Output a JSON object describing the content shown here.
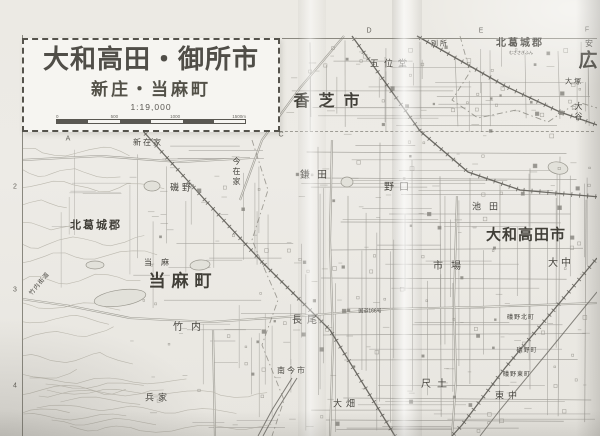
{
  "map": {
    "title_box": {
      "title": "大和高田・御所市",
      "subtitle": "新庄・当麻町",
      "scale": "1:19,000",
      "scale_bar_labels": [
        "0",
        "500",
        "1000",
        "1500m"
      ]
    },
    "colors": {
      "paper": "#edebe5",
      "street_line": "#a3a19b",
      "rail_line": "#5f5d57",
      "label_text": "#46443e",
      "title_text": "#504e48"
    },
    "grid_letters": [
      {
        "t": "A",
        "x": 68,
        "y": 139
      },
      {
        "t": "C",
        "x": 281,
        "y": 135
      },
      {
        "t": "D",
        "x": 369,
        "y": 31
      },
      {
        "t": "E",
        "x": 481,
        "y": 31
      },
      {
        "t": "F",
        "x": 587,
        "y": 30
      }
    ],
    "grid_numbers": [
      {
        "t": "2",
        "x": 15,
        "y": 187
      },
      {
        "t": "3",
        "x": 15,
        "y": 290
      },
      {
        "t": "4",
        "x": 15,
        "y": 386
      }
    ],
    "labels": [
      {
        "text": "香芝市",
        "x": 331,
        "y": 102,
        "size": 16,
        "ls": 9,
        "bold": true
      },
      {
        "text": "北葛城郡",
        "x": 520,
        "y": 44,
        "size": 10,
        "ls": 2,
        "bold": true
      },
      {
        "text": "むささぎふん",
        "x": 521,
        "y": 53,
        "size": 4,
        "ls": 0
      },
      {
        "text": "広",
        "x": 588,
        "y": 61,
        "size": 19,
        "ls": 0,
        "bold": true
      },
      {
        "text": "安",
        "x": 589,
        "y": 44,
        "size": 8,
        "ls": 0
      },
      {
        "text": "五位堂",
        "x": 391,
        "y": 64,
        "size": 9,
        "ls": 5
      },
      {
        "text": "別所",
        "x": 440,
        "y": 44,
        "size": 7,
        "ls": 2
      },
      {
        "text": "大塚",
        "x": 574,
        "y": 82,
        "size": 7,
        "ls": 2
      },
      {
        "text": "大谷",
        "x": 578,
        "y": 112,
        "size": 8,
        "ls": 2,
        "vert": true
      },
      {
        "text": "北葛城郡",
        "x": 96,
        "y": 226,
        "size": 11,
        "ls": 2,
        "bold": true
      },
      {
        "text": "当麻",
        "x": 161,
        "y": 263,
        "size": 8,
        "ls": 9
      },
      {
        "text": "当麻町",
        "x": 183,
        "y": 281,
        "size": 17,
        "ls": 6,
        "bold": true
      },
      {
        "text": "大和高田市",
        "x": 526,
        "y": 235,
        "size": 15,
        "ls": 1,
        "bold": true
      },
      {
        "text": "新在家",
        "x": 148,
        "y": 143,
        "size": 8,
        "ls": 2
      },
      {
        "text": "今在家",
        "x": 236,
        "y": 172,
        "size": 8,
        "ls": 2,
        "vert": true
      },
      {
        "text": "磯野",
        "x": 182,
        "y": 188,
        "size": 9,
        "ls": 3
      },
      {
        "text": "鎌田",
        "x": 317,
        "y": 176,
        "size": 10,
        "ls": 7
      },
      {
        "text": "野口",
        "x": 399,
        "y": 188,
        "size": 10,
        "ls": 5
      },
      {
        "text": "池田",
        "x": 489,
        "y": 207,
        "size": 9,
        "ls": 8
      },
      {
        "text": "市場",
        "x": 451,
        "y": 267,
        "size": 10,
        "ls": 8
      },
      {
        "text": "大中",
        "x": 561,
        "y": 264,
        "size": 10,
        "ls": 3
      },
      {
        "text": "竹内",
        "x": 191,
        "y": 328,
        "size": 10,
        "ls": 8
      },
      {
        "text": "長尾",
        "x": 307,
        "y": 321,
        "size": 10,
        "ls": 5
      },
      {
        "text": "国道166号",
        "x": 370,
        "y": 312,
        "size": 5,
        "ls": 0
      },
      {
        "text": "竹内街道",
        "x": 40,
        "y": 284,
        "size": 6,
        "ls": 1,
        "rot": -50
      },
      {
        "text": "礒野北町",
        "x": 521,
        "y": 318,
        "size": 6,
        "ls": 1
      },
      {
        "text": "礒野町",
        "x": 527,
        "y": 351,
        "size": 6,
        "ls": 1
      },
      {
        "text": "礒野東町",
        "x": 517,
        "y": 375,
        "size": 6,
        "ls": 1
      },
      {
        "text": "南今市",
        "x": 292,
        "y": 371,
        "size": 8,
        "ls": 2
      },
      {
        "text": "兵家",
        "x": 158,
        "y": 398,
        "size": 9,
        "ls": 4
      },
      {
        "text": "大畑",
        "x": 346,
        "y": 404,
        "size": 9,
        "ls": 4
      },
      {
        "text": "尺土",
        "x": 437,
        "y": 385,
        "size": 10,
        "ls": 6
      },
      {
        "text": "東中",
        "x": 508,
        "y": 396,
        "size": 9,
        "ls": 4
      }
    ]
  }
}
